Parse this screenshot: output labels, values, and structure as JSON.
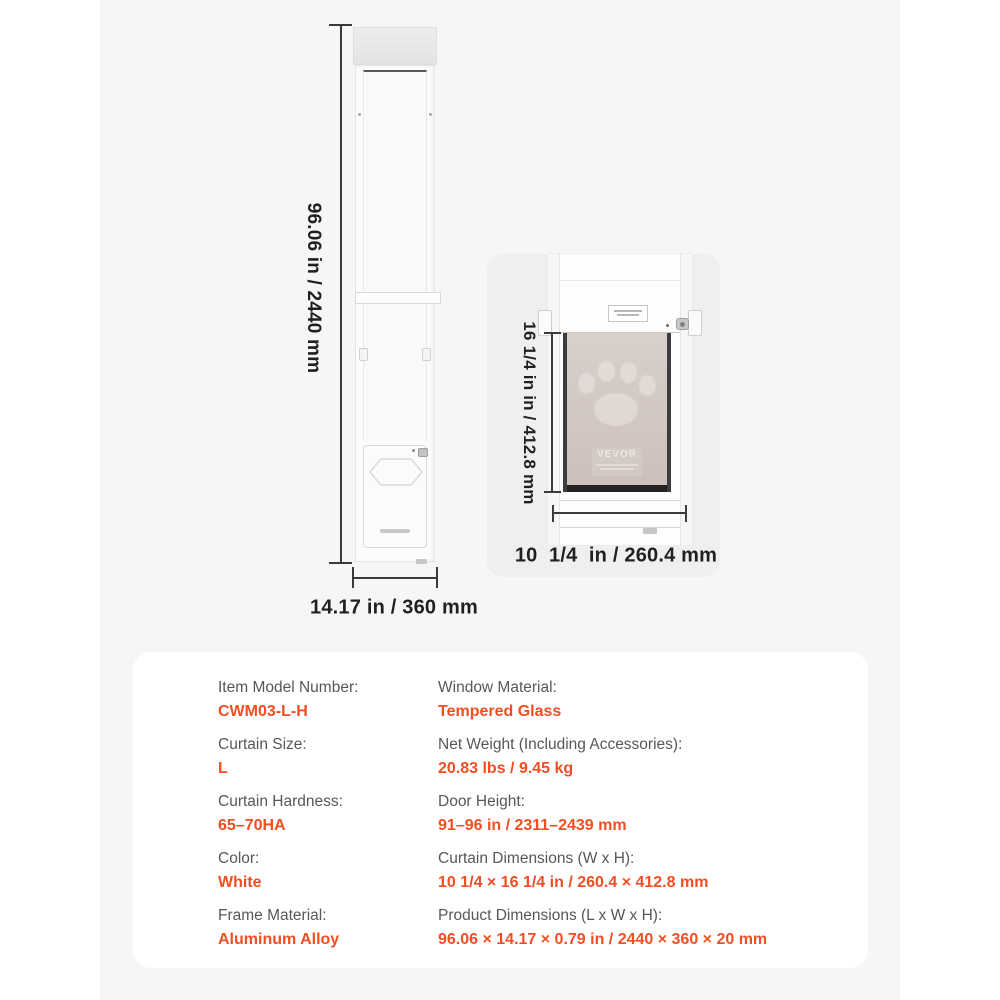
{
  "colors": {
    "accent": "#f04e23",
    "band_background": "#f6f6f7",
    "detail_card_background": "#efeff1",
    "dimension_text": "#1f2022",
    "spec_label_gray": "#56575b"
  },
  "diagram": {
    "door_height_label": "96.06 in / 2440 mm",
    "door_width_label": "14.17 in / 360 mm",
    "detail": {
      "flap_height_label": "16 1/4 in in / 412.8 mm",
      "flap_width_label": "10  1/4  in / 260.4 mm",
      "glass_watermark": "VEVOR"
    }
  },
  "specs": {
    "left": [
      {
        "label": "Item Model Number:",
        "value": "CWM03-L-H"
      },
      {
        "label": "Curtain Size:",
        "value": "L"
      },
      {
        "label": "Curtain Hardness:",
        "value": "65–70HA"
      },
      {
        "label": "Color:",
        "value": "White"
      },
      {
        "label": "Frame Material:",
        "value": "Aluminum Alloy"
      }
    ],
    "right": [
      {
        "label": "Window Material:",
        "value": "Tempered Glass"
      },
      {
        "label": "Net Weight (Including Accessories):",
        "value": "20.83 lbs / 9.45 kg"
      },
      {
        "label": "Door Height:",
        "value": "91–96 in / 2311–2439 mm"
      },
      {
        "label": "Curtain Dimensions (W x H):",
        "value": "10 1/4 × 16 1/4 in / 260.4 × 412.8 mm"
      },
      {
        "label": "Product Dimensions (L x W x H):",
        "value": "96.06 × 14.17 × 0.79 in / 2440 × 360 × 20 mm"
      }
    ]
  }
}
